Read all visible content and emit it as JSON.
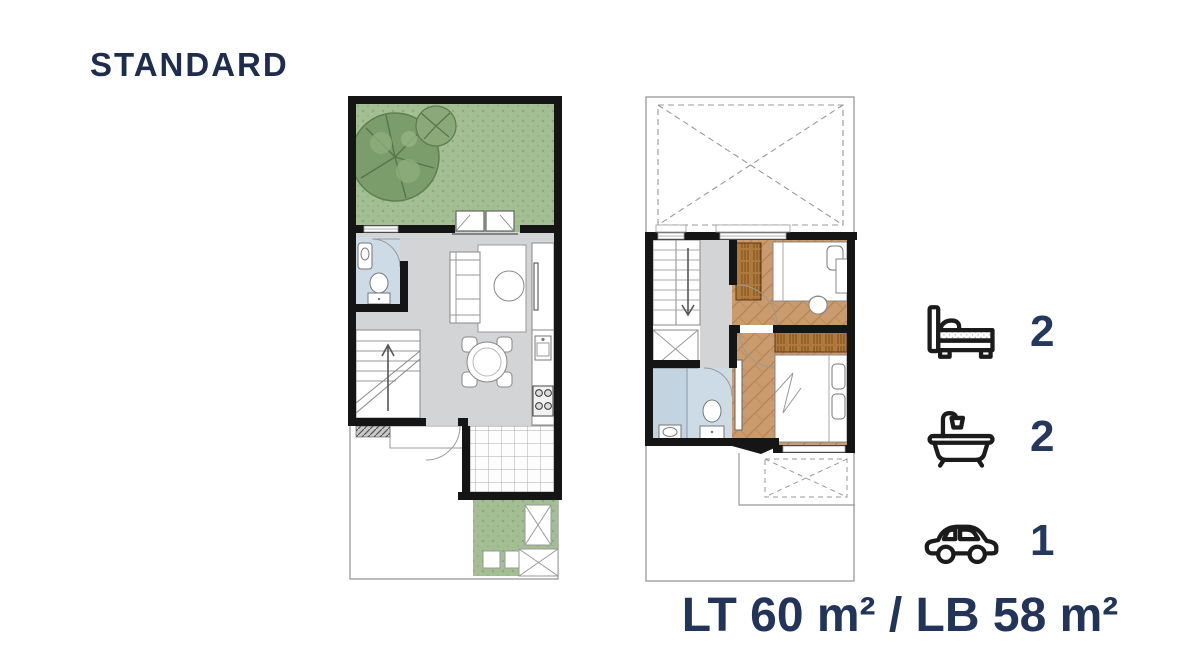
{
  "title": "STANDARD",
  "features": [
    {
      "name": "bedrooms",
      "icon": "bed-icon",
      "count": "2"
    },
    {
      "name": "bathrooms",
      "icon": "bathtub-icon",
      "count": "2"
    },
    {
      "name": "carport",
      "icon": "car-icon",
      "count": "1"
    }
  ],
  "area_label": "LT 60 m² / LB 58 m²",
  "colors": {
    "navy": "#22345A",
    "wall_black": "#151515",
    "garden_green": "#A4BE94",
    "tree_green": "#6E9360",
    "floor_gray": "#D3D4D6",
    "bathroom_blue": "#CDDBE6",
    "wood_floor": "#C99B6D",
    "wardrobe_wood": "#B0793C"
  }
}
